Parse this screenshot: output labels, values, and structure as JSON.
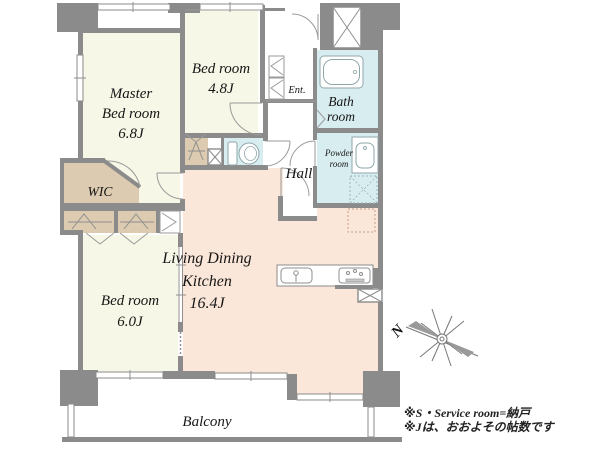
{
  "floorplan": {
    "rooms": {
      "master_bedroom": {
        "line1": "Master",
        "line2": "Bed room",
        "line3": "6.8J"
      },
      "bedroom_48": {
        "line1": "Bed room",
        "line2": "4.8J"
      },
      "bedroom_60": {
        "line1": "Bed room",
        "line2": "6.0J"
      },
      "ldk": {
        "line1": "Living Dining",
        "line2": "Kitchen",
        "line3": "16.4J"
      },
      "hall": {
        "label": "Hall"
      },
      "entrance": {
        "label": "Ent."
      },
      "bathroom": {
        "line1": "Bath",
        "line2": "room"
      },
      "powder_room": {
        "line1": "Powder",
        "line2": "room"
      },
      "wic": {
        "label": "WIC"
      },
      "balcony": {
        "label": "Balcony"
      }
    },
    "compass": {
      "north_label": "N"
    },
    "notes": {
      "line1": "※S・Service room=納戸",
      "line2": "※Jは、おおよその帖数です"
    },
    "colors": {
      "wall": "#8b8b8b",
      "room_cream": "#f7f7e7",
      "closet_tan": "#dccbb0",
      "wet_blue": "#d8edf0",
      "ldk_peach": "#fbe7d9"
    }
  }
}
